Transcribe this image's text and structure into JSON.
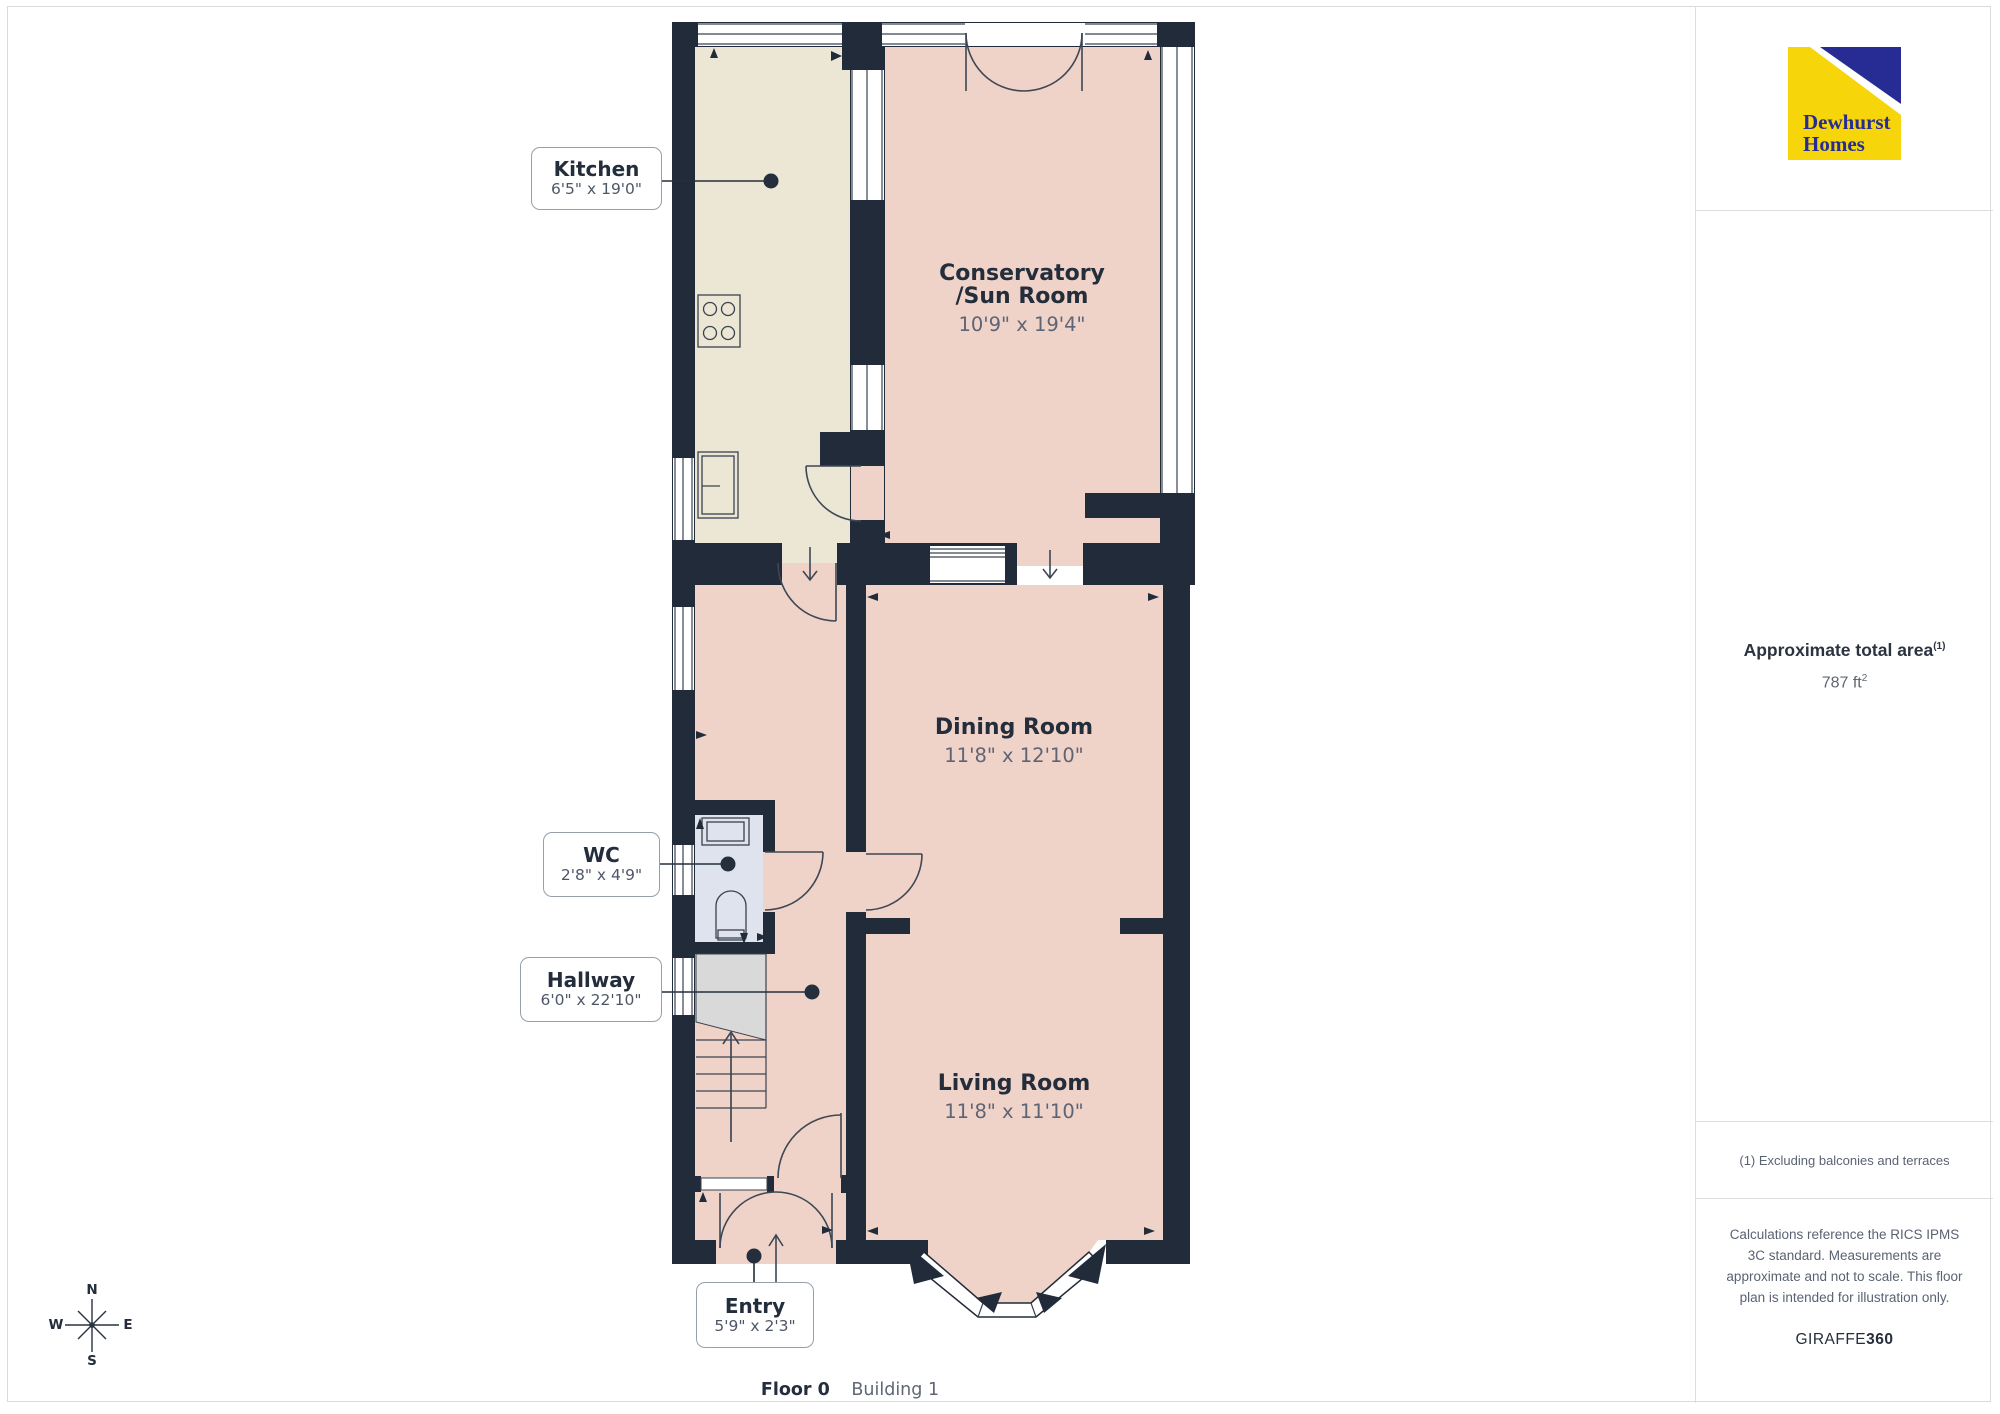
{
  "page": {
    "background": "#ffffff",
    "border_color": "#d9dbdd"
  },
  "branding": {
    "logo_line1": "Dewhurst",
    "logo_line2": "Homes",
    "logo_yellow": "#f6d60a",
    "logo_blue": "#262c94"
  },
  "sidebar": {
    "area_label": "Approximate total area",
    "area_label_sup": "(1)",
    "area_value": "787 ft",
    "area_value_sup": "2",
    "footnote": "(1) Excluding balconies and terraces",
    "disclaimer": "Calculations reference the RICS IPMS 3C standard. Measurements are approximate and not to scale. This floor plan is intended for illustration only.",
    "brand_mark_regular": "GIRAFFE",
    "brand_mark_bold": "360"
  },
  "floor_bar": {
    "floor_label": "Floor 0",
    "building_label": "Building 1"
  },
  "compass": {
    "n": "N",
    "s": "S",
    "e": "E",
    "w": "W"
  },
  "floorplan": {
    "rooms": {
      "kitchen": {
        "name": "Kitchen",
        "dims": "6'5\" x 19'0\""
      },
      "conservatory": {
        "name_line1": "Conservatory",
        "name_line2": "/Sun Room",
        "dims": "10'9\" x 19'4\""
      },
      "dining": {
        "name": "Dining Room",
        "dims": "11'8\" x 12'10\""
      },
      "wc": {
        "name": "WC",
        "dims": "2'8\" x 4'9\""
      },
      "hallway": {
        "name": "Hallway",
        "dims": "6'0\" x 22'10\""
      },
      "living": {
        "name": "Living Room",
        "dims": "11'8\" x 11'10\""
      },
      "entry": {
        "name": "Entry",
        "dims": "5'9\" x 2'3\""
      }
    },
    "colors": {
      "wall": "#212b39",
      "room_pink": "#f0d3c8",
      "room_cream": "#ece7d5",
      "room_wc": "#dfe3ee",
      "stairs_gray": "#d9d9d9"
    }
  }
}
